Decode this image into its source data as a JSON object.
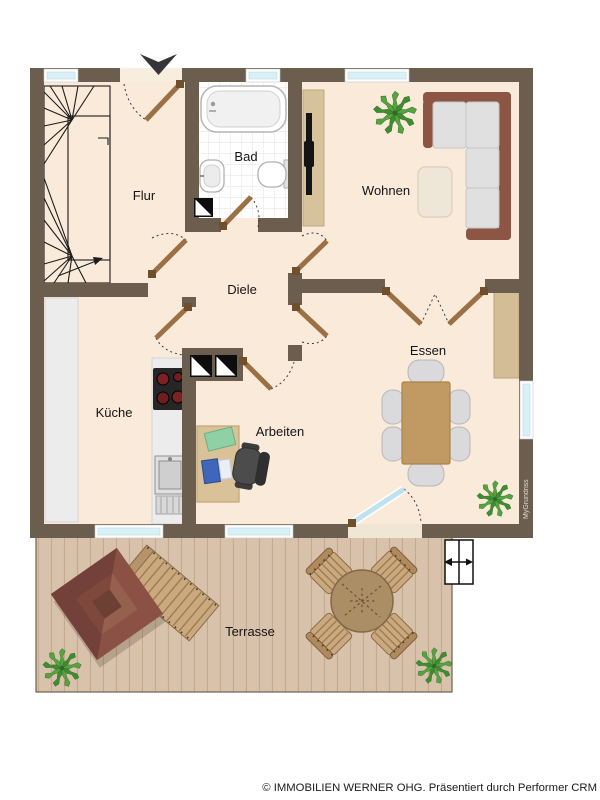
{
  "plan": {
    "type": "apartment-floor-plan",
    "rooms": {
      "flur": "Flur",
      "bad": "Bad",
      "wohnen": "Wohnen",
      "diele": "Diele",
      "kueche": "Küche",
      "arbeiten": "Arbeiten",
      "essen": "Essen",
      "terrasse": "Terrasse"
    },
    "watermark": "MyGrundriss",
    "furniture": {
      "flur": [
        "winder-staircase"
      ],
      "bad": [
        "bathtub",
        "washbasin",
        "toilet",
        "shaft"
      ],
      "wohnen": [
        "corner-sofa",
        "coffee-table",
        "tv-sideboard",
        "plant"
      ],
      "kueche": [
        "kitchen-counter",
        "stove",
        "kitchen-sink"
      ],
      "arbeiten": [
        "desk",
        "laptop",
        "office-chair"
      ],
      "essen": [
        "dining-table",
        "dining-chairs-6",
        "sideboard",
        "plant"
      ],
      "terrasse": [
        "pavilion",
        "sun-lounger",
        "round-table",
        "chairs-4",
        "plants-2",
        "exterior-steps"
      ]
    },
    "colors": {
      "wall": "#6b5e4f",
      "floor": "#faead9",
      "bath_floor": "#ffffff",
      "terrace_deck": "#d8c2ab",
      "window_glass": "#d9f0f6",
      "door_leaf": "#9c7045",
      "plant_green": "#4f9c3e",
      "pavilion": "#7c4637",
      "sofa_frame": "#8c5544"
    }
  },
  "footer": {
    "copyright": "© IMMOBILIEN WERNER OHG. Präsentiert durch Performer CRM"
  }
}
